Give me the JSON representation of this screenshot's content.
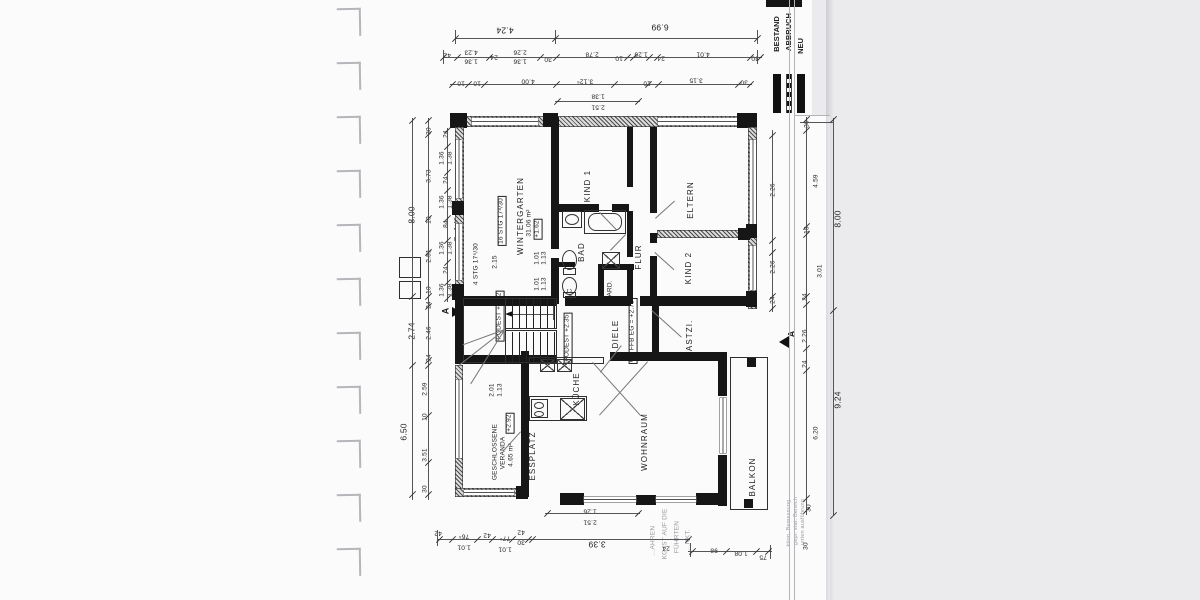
{
  "legend": {
    "items": [
      {
        "label": "BESTAND",
        "style": "solid-thick-bar"
      },
      {
        "label": "ABBRUCH",
        "style": "dashed-bar"
      },
      {
        "label": "NEU",
        "style": "solid-bar"
      }
    ]
  },
  "labels": {
    "rooms": [
      {
        "t": "KIND 1",
        "x": 588,
        "y": 186
      },
      {
        "t": "ELTERN",
        "x": 691,
        "y": 200
      },
      {
        "t": "KIND 2",
        "x": 689,
        "y": 268
      },
      {
        "t": "FLUR",
        "x": 639,
        "y": 257
      },
      {
        "t": "BAD",
        "x": 582,
        "y": 252
      },
      {
        "t": "GARD.",
        "x": 611,
        "y": 291,
        "c": "dim"
      },
      {
        "t": "WC",
        "x": 571,
        "y": 294,
        "c": "dim"
      },
      {
        "t": "DIELE",
        "x": 616,
        "y": 334
      },
      {
        "t": "GASTZI.",
        "x": 690,
        "y": 339
      },
      {
        "t": "KÜCHE",
        "x": 577,
        "y": 389
      },
      {
        "t": "ESSPLATZ",
        "x": 533,
        "y": 456
      },
      {
        "t": "WOHNRAUM",
        "x": 645,
        "y": 442
      },
      {
        "t": "BALKON",
        "x": 753,
        "y": 477
      },
      {
        "t": "WINTERGARTEN",
        "x": 521,
        "y": 216
      },
      {
        "t": "31.06 m²",
        "x": 530,
        "y": 223,
        "c": "dim"
      },
      {
        "t": "GESCHLOSSENE",
        "x": 496,
        "y": 452,
        "c": "dim"
      },
      {
        "t": "VERANDA",
        "x": 504,
        "y": 453,
        "c": "dim"
      },
      {
        "t": "4.65 m²",
        "x": 512,
        "y": 455,
        "c": "dim"
      }
    ],
    "levels": [
      {
        "t": "+1.62",
        "x": 538,
        "y": 229
      },
      {
        "t": "+2.92",
        "x": 510,
        "y": 423
      },
      {
        "t": "OK FFB EG = +2.75",
        "x": 633,
        "y": 331
      },
      {
        "t": "PODEST +1.92",
        "x": 500,
        "y": 316
      },
      {
        "t": "PODEST +2.35",
        "x": 568,
        "y": 338
      }
    ],
    "stairs": [
      {
        "t": "16 STG 17⁸/30",
        "x": 502,
        "y": 221,
        "c": "box"
      },
      {
        "t": "4 STG 17⁵/30",
        "x": 477,
        "y": 264
      },
      {
        "t": "Br. 1.40",
        "x": 458,
        "y": 229
      }
    ],
    "dims_top": [
      {
        "t": "4.24",
        "x": 505,
        "y": 30,
        "c": "big"
      },
      {
        "t": "6.99",
        "x": 660,
        "y": 27,
        "c": "big"
      },
      {
        "t": "42",
        "x": 447,
        "y": 54
      },
      {
        "t": "4.23",
        "x": 471,
        "y": 51
      },
      {
        "t": "1.36",
        "x": 471,
        "y": 60
      },
      {
        "t": "24",
        "x": 494,
        "y": 56
      },
      {
        "t": "2.26",
        "x": 520,
        "y": 51
      },
      {
        "t": "1.36",
        "x": 520,
        "y": 60
      },
      {
        "t": "30",
        "x": 548,
        "y": 58
      },
      {
        "t": "2.78",
        "x": 592,
        "y": 53
      },
      {
        "t": "10",
        "x": 619,
        "y": 57
      },
      {
        "t": "1.26",
        "x": 641,
        "y": 53
      },
      {
        "t": "24",
        "x": 661,
        "y": 57
      },
      {
        "t": "4.01",
        "x": 703,
        "y": 53
      },
      {
        "t": "30",
        "x": 755,
        "y": 57
      },
      {
        "t": "10",
        "x": 461,
        "y": 82
      },
      {
        "t": "10",
        "x": 477,
        "y": 82
      },
      {
        "t": "4.00",
        "x": 528,
        "y": 80
      },
      {
        "t": "3.12⁵",
        "x": 585,
        "y": 80
      },
      {
        "t": "10",
        "x": 647,
        "y": 82
      },
      {
        "t": "3.15",
        "x": 696,
        "y": 79
      },
      {
        "t": "30",
        "x": 744,
        "y": 81
      },
      {
        "t": "1.38",
        "x": 598,
        "y": 95
      },
      {
        "t": "2.51",
        "x": 598,
        "y": 106
      }
    ],
    "dims_left": [
      {
        "t": "8.00",
        "x": 412,
        "y": 215,
        "c": "big"
      },
      {
        "t": "30",
        "x": 430,
        "y": 131
      },
      {
        "t": "3.73",
        "x": 430,
        "y": 176
      },
      {
        "t": "10",
        "x": 430,
        "y": 220
      },
      {
        "t": "2.51",
        "x": 430,
        "y": 256
      },
      {
        "t": "10",
        "x": 430,
        "y": 290
      },
      {
        "t": "24",
        "x": 430,
        "y": 305
      },
      {
        "t": "2.74",
        "x": 412,
        "y": 331,
        "c": "big"
      },
      {
        "t": "2.46",
        "x": 430,
        "y": 333
      },
      {
        "t": "24",
        "x": 430,
        "y": 358
      },
      {
        "t": "6.50",
        "x": 404,
        "y": 432,
        "c": "big"
      },
      {
        "t": "2.59",
        "x": 426,
        "y": 389
      },
      {
        "t": "10",
        "x": 426,
        "y": 417
      },
      {
        "t": "3.51",
        "x": 426,
        "y": 455
      },
      {
        "t": "30",
        "x": 426,
        "y": 489
      },
      {
        "t": "24",
        "x": 447,
        "y": 134
      },
      {
        "t": "1.36",
        "x": 443,
        "y": 158
      },
      {
        "t": "1.38",
        "x": 451,
        "y": 158
      },
      {
        "t": "24",
        "x": 447,
        "y": 180
      },
      {
        "t": "1.36",
        "x": 443,
        "y": 202
      },
      {
        "t": "1.38",
        "x": 451,
        "y": 202
      },
      {
        "t": "84",
        "x": 447,
        "y": 224
      },
      {
        "t": "1.36",
        "x": 443,
        "y": 248
      },
      {
        "t": "1.38",
        "x": 451,
        "y": 248
      },
      {
        "t": "24",
        "x": 447,
        "y": 270
      },
      {
        "t": "1.36",
        "x": 443,
        "y": 290
      },
      {
        "t": "1.38",
        "x": 451,
        "y": 290
      },
      {
        "t": "2.15",
        "x": 496,
        "y": 262
      },
      {
        "t": "1.01",
        "x": 538,
        "y": 258
      },
      {
        "t": "1.13",
        "x": 545,
        "y": 258
      },
      {
        "t": "1.01",
        "x": 538,
        "y": 284
      },
      {
        "t": "1.13",
        "x": 545,
        "y": 284
      },
      {
        "t": "2.01",
        "x": 493,
        "y": 390
      },
      {
        "t": "1.13",
        "x": 501,
        "y": 390
      }
    ],
    "dims_right": [
      {
        "t": "2.26",
        "x": 774,
        "y": 190
      },
      {
        "t": "2.26",
        "x": 774,
        "y": 267
      },
      {
        "t": "24",
        "x": 774,
        "y": 300
      },
      {
        "t": "30",
        "x": 808,
        "y": 124
      },
      {
        "t": "4.59",
        "x": 817,
        "y": 181
      },
      {
        "t": "10",
        "x": 808,
        "y": 230
      },
      {
        "t": "3.01",
        "x": 821,
        "y": 271
      },
      {
        "t": "24",
        "x": 806,
        "y": 297
      },
      {
        "t": "8.00",
        "x": 838,
        "y": 219,
        "c": "big"
      },
      {
        "t": "2.26",
        "x": 806,
        "y": 336
      },
      {
        "t": "24",
        "x": 806,
        "y": 364
      },
      {
        "t": "9.24",
        "x": 838,
        "y": 400,
        "c": "big"
      },
      {
        "t": "6.20",
        "x": 817,
        "y": 433
      },
      {
        "t": "30",
        "x": 810,
        "y": 508
      },
      {
        "t": "30",
        "x": 807,
        "y": 546
      }
    ],
    "dims_bottom": [
      {
        "t": "1.26",
        "x": 590,
        "y": 510
      },
      {
        "t": "2.51",
        "x": 590,
        "y": 521
      },
      {
        "t": "42",
        "x": 438,
        "y": 532
      },
      {
        "t": "76⁵",
        "x": 464,
        "y": 535
      },
      {
        "t": "1.01",
        "x": 464,
        "y": 546
      },
      {
        "t": "42",
        "x": 487,
        "y": 534
      },
      {
        "t": "77⁵",
        "x": 505,
        "y": 537
      },
      {
        "t": "1.01",
        "x": 505,
        "y": 548
      },
      {
        "t": "42",
        "x": 521,
        "y": 531
      },
      {
        "t": "30",
        "x": 521,
        "y": 541
      },
      {
        "t": "3.39",
        "x": 597,
        "y": 544,
        "c": "big"
      },
      {
        "t": "24",
        "x": 666,
        "y": 547
      },
      {
        "t": "98",
        "x": 714,
        "y": 549
      },
      {
        "t": "1.08",
        "x": 741,
        "y": 552
      },
      {
        "t": "75",
        "x": 763,
        "y": 556
      }
    ],
    "notes": [
      {
        "t": "…AHREN",
        "x": 654,
        "y": 541
      },
      {
        "t": "KG IST AUF DIE",
        "x": 666,
        "y": 534
      },
      {
        "t": "FÜHRTEN",
        "x": 678,
        "y": 537
      },
      {
        "t": "…NKT.",
        "x": 689,
        "y": 540
      },
      {
        "t": "ktion. Bemessung",
        "x": 790,
        "y": 523,
        "c": "tiny"
      },
      {
        "t": "gepr. stat. Bereich",
        "x": 797,
        "y": 521,
        "c": "tiny"
      },
      {
        "t": "unten ausführung",
        "x": 804,
        "y": 522,
        "c": "tiny"
      }
    ],
    "markers": [
      {
        "t": "A",
        "x": 446,
        "y": 311
      },
      {
        "t": "A",
        "x": 792,
        "y": 334
      }
    ]
  }
}
